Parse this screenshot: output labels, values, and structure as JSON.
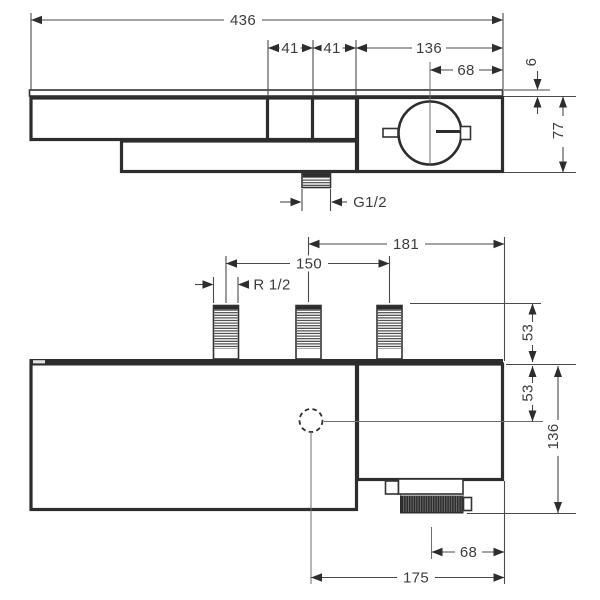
{
  "labels": {
    "front": {
      "overall_width": "436",
      "button1_width": "41",
      "button2_width": "41",
      "right_section_width": "136",
      "handle_offset": "68",
      "plate_thickness": "6",
      "body_height": "77",
      "outlet_thread": "G1/2"
    },
    "plan": {
      "handle_span": "181",
      "pipe_spacing": "150",
      "pipe_thread": "R 1/2",
      "pipe_length": "53",
      "top_to_center": "53",
      "total_depth": "136",
      "handle_offset": "68",
      "outlet_offset": "175"
    }
  },
  "colors": {
    "ink": "#2d2d2d",
    "dim_line": "#4a4a4a",
    "background": "#ffffff"
  }
}
